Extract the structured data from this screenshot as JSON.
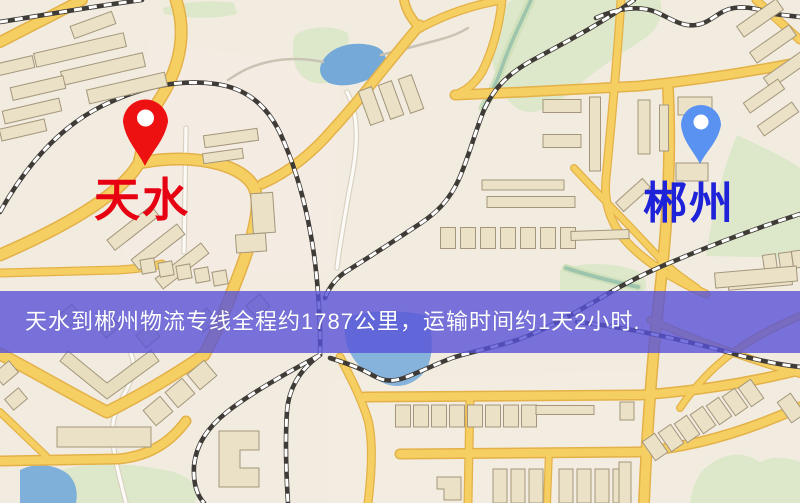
{
  "map": {
    "origin": {
      "label": "天水",
      "label_color": "#e60012",
      "marker_color": "#ee1111"
    },
    "destination": {
      "label": "郴州",
      "label_color": "#1e22d8",
      "marker_color": "#5992f0"
    },
    "banner": {
      "text": "天水到郴州物流专线全程约1787公里，运输时间约1天2小时.",
      "distance_km": "1787",
      "duration": "1天2小时",
      "background": "#5753d7",
      "text_color": "#ffffff"
    }
  }
}
